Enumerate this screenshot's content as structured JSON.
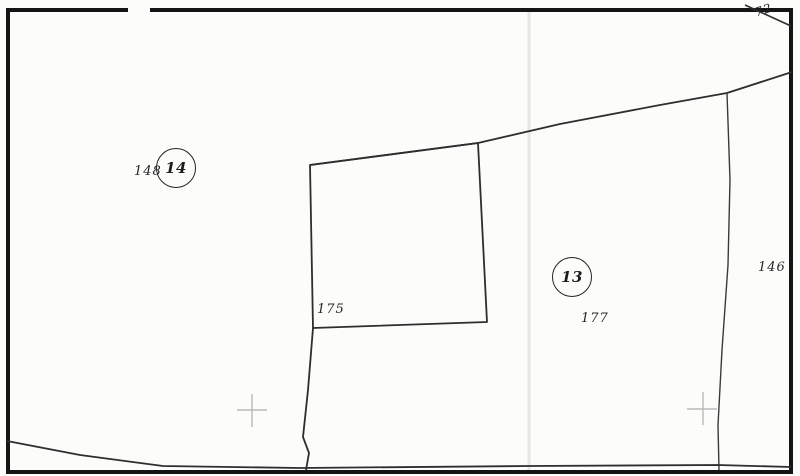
{
  "map": {
    "colors": {
      "line": "#2e2e2e",
      "frame": "#141414",
      "cross": "#b9b9b9",
      "crease": "#e6e6e3",
      "paper": "#fcfcfb"
    },
    "circled_parcels": [
      {
        "number": "14"
      },
      {
        "number": "13"
      }
    ],
    "parcel_numbers": {
      "p148": "148",
      "p175": "175",
      "p177": "177",
      "p146": "146",
      "p72": "72"
    }
  }
}
